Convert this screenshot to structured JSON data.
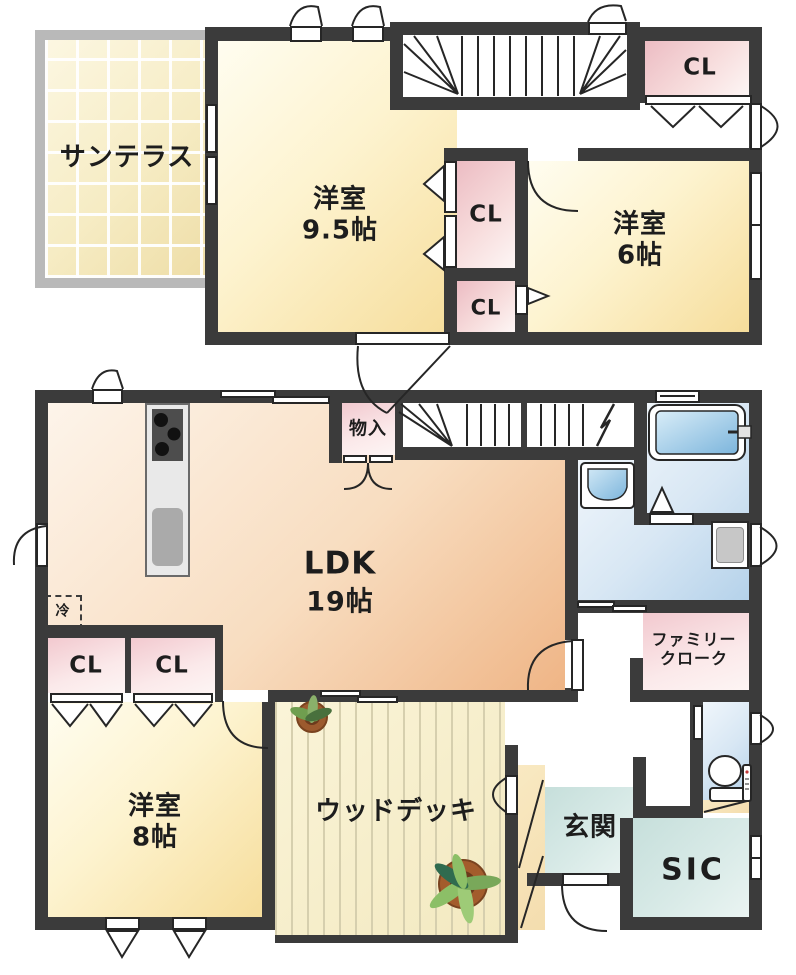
{
  "floor2": {
    "sun_terrace": "サンテラス",
    "room_9_5": {
      "name": "洋室",
      "size": "9.5帖"
    },
    "room_6": {
      "name": "洋室",
      "size": "6帖"
    },
    "closet_hall": "CL",
    "closet_upper": "CL",
    "closet_lower": "CL"
  },
  "floor1": {
    "ldk": {
      "name": "LDK",
      "size": "19帖"
    },
    "storage": "物入",
    "fridge": "冷",
    "closet_a": "CL",
    "closet_b": "CL",
    "room_8": {
      "name": "洋室",
      "size": "8帖"
    },
    "wood_deck": "ウッドデッキ",
    "entrance": "玄関",
    "shoe_closet": "SIC",
    "family_cloak": {
      "line1": "ファミリー",
      "line2": "クローク"
    }
  },
  "colors": {
    "wall": "#3b3b3b",
    "room_yellow": "#f6dd9b",
    "ldk_peach": "#efb586",
    "closet_pink": "#ecbcc3",
    "water_blue": "#b5d2ea",
    "entrance_teal": "#c6dfdb",
    "deck_cream": "#f3e9c0",
    "terrace_border_gray": "#b9b9b9"
  }
}
